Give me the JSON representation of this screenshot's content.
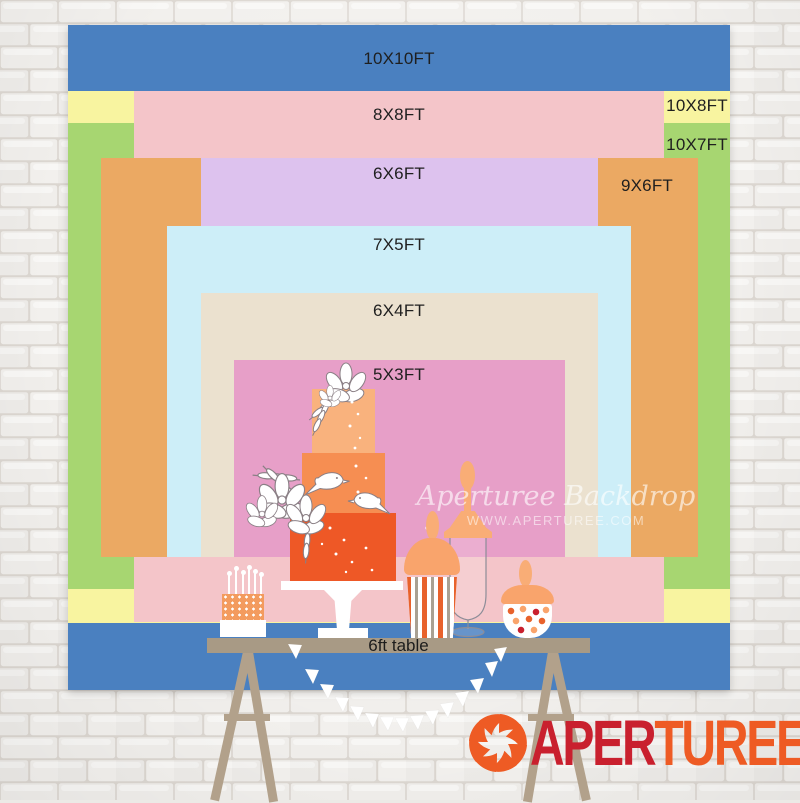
{
  "size_chart": {
    "label_color": "#1f1f1f",
    "layers": [
      {
        "id": "10x10",
        "label": "10X10FT",
        "color": "#4a80c0"
      },
      {
        "id": "10x8",
        "label": "10X8FT",
        "color": "#f8f4a0"
      },
      {
        "id": "10x7",
        "label": "10X7FT",
        "color": "#a7d671"
      },
      {
        "id": "8x8",
        "label": "8X8FT",
        "color": "#f4c5c9"
      },
      {
        "id": "9x6",
        "label": "9X6FT",
        "color": "#eba963"
      },
      {
        "id": "6x6",
        "label": "6X6FT",
        "color": "#ddc2ee"
      },
      {
        "id": "7x5",
        "label": "7X5FT",
        "color": "#cdeef8"
      },
      {
        "id": "6x4",
        "label": "6X4FT",
        "color": "#ebe1cf"
      },
      {
        "id": "5x3",
        "label": "5X3FT",
        "color": "#e79fc8"
      }
    ]
  },
  "table": {
    "label": "6ft table",
    "bar_color": "#a89a85",
    "leg_color": "#b2a18b"
  },
  "watermark": {
    "line1": "Aperturee Backdrop",
    "line2": "WWW.APERTUREE.COM"
  },
  "logo": {
    "icon": "aperture-icon",
    "icon_color": "#ee5b24",
    "part1": "APER",
    "part1_color": "#c9202e",
    "part2": "TUREE",
    "part2_color": "#ee5b24"
  },
  "illustration": {
    "cake_top_color": "#f9b27d",
    "cake_mid_color": "#f68e52",
    "cake_bottom_color": "#ee5826",
    "jar_orange": "#f9a46c",
    "jar_silhouette": "#f9ad76",
    "pops_color": "#f39b5e",
    "stripe_orange": "#e8622c",
    "stripe_gray": "#a9a193",
    "bunting_color": "#ffffff"
  }
}
